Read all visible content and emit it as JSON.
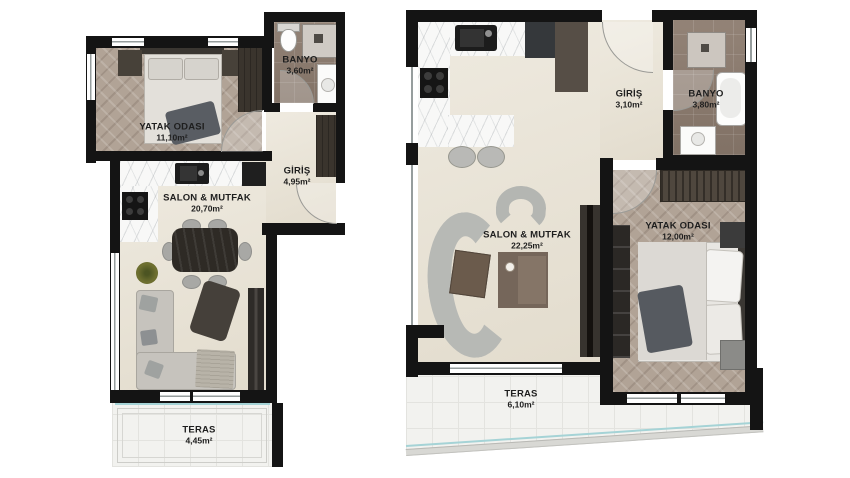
{
  "plan": {
    "left_unit": {
      "bedroom": {
        "name": "YATAK ODASI",
        "area": "11,10m²"
      },
      "bathroom": {
        "name": "BANYO",
        "area": "3,60m²"
      },
      "entrance": {
        "name": "GİRİŞ",
        "area": "4,95m²"
      },
      "living_kitchen": {
        "name": "SALON & MUTFAK",
        "area": "20,70m²"
      },
      "terrace": {
        "name": "TERAS",
        "area": "4,45m²"
      }
    },
    "right_unit": {
      "entrance": {
        "name": "GİRİŞ",
        "area": "3,10m²"
      },
      "bathroom": {
        "name": "BANYO",
        "area": "3,80m²"
      },
      "living_kitchen": {
        "name": "SALON & MUTFAK",
        "area": "22,25m²"
      },
      "bedroom": {
        "name": "YATAK ODASI",
        "area": "12,00m²"
      },
      "terrace": {
        "name": "TERAS",
        "area": "6,10m²"
      }
    }
  },
  "colors": {
    "wall": "#141414",
    "cream_floor": "#e9e3d5",
    "herringbone_floor": "#b1a396",
    "bathroom_tile": "#8c7b6e",
    "terrace_tile": "#f2f2ef",
    "marble_counter": "#f8f8f7",
    "sofa_gray": "#c0bdb7",
    "railing_teal": "#a5d3d6",
    "plant_green": "#6f7030"
  }
}
